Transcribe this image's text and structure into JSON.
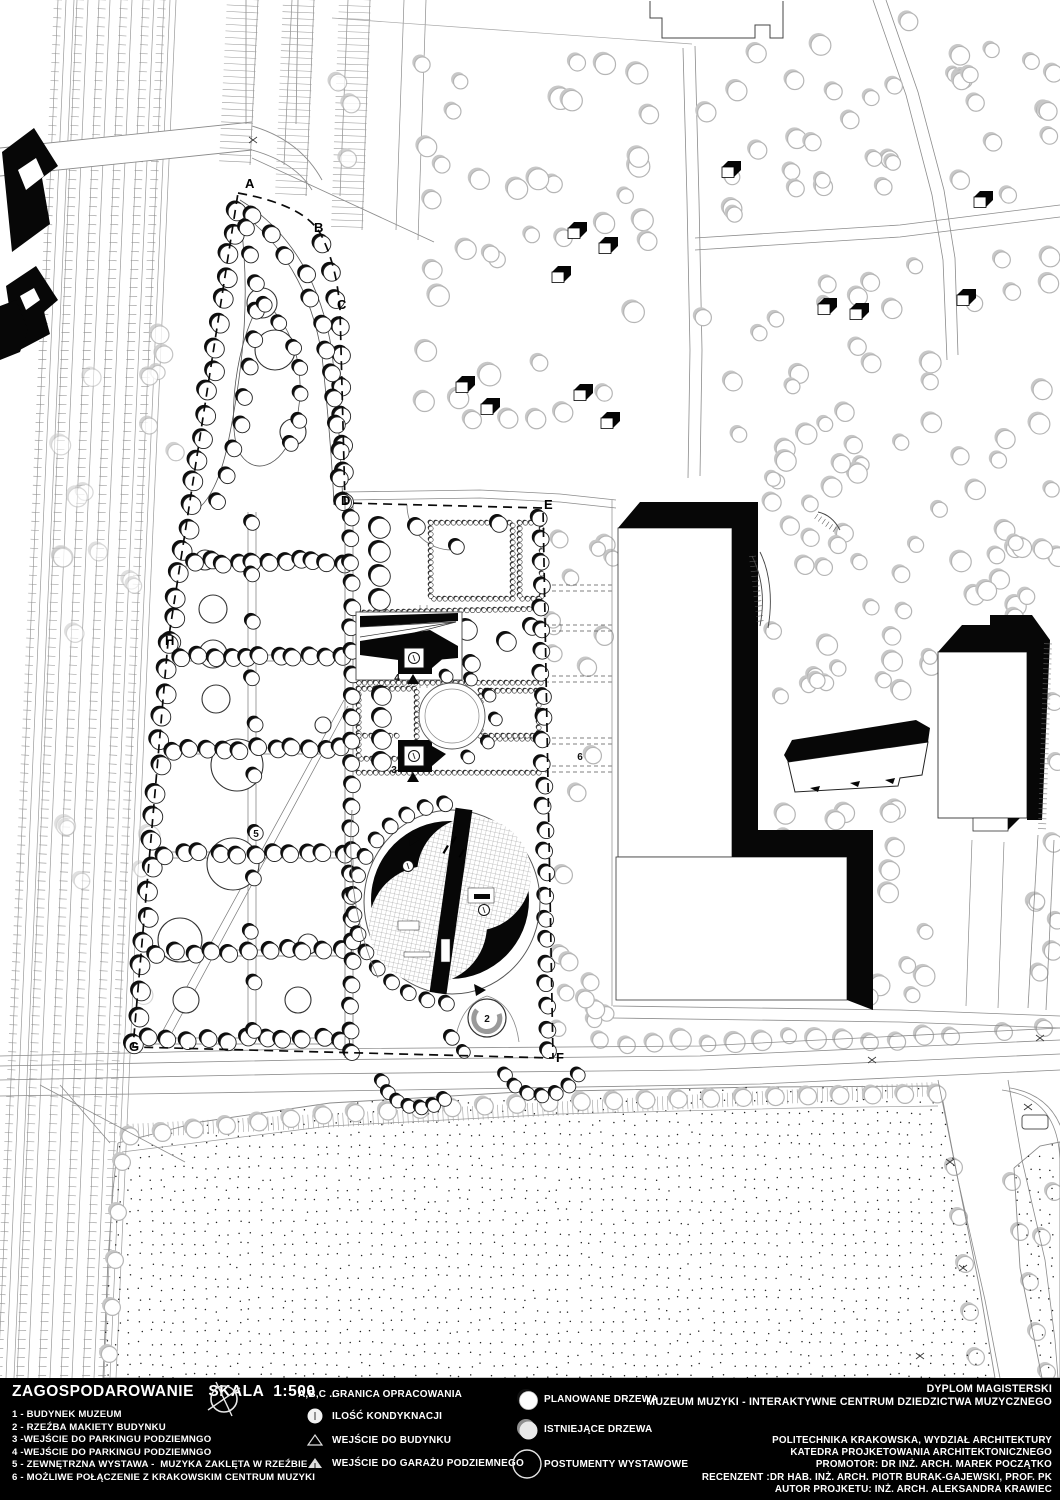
{
  "legend": {
    "title": "ZAGOSPODAROWANIE   SKALA  1:500",
    "numbered_items": [
      "1 - BUDYNEK MUZEUM",
      "2 - RZEŹBA MAKIETY BUDYNKU",
      "3 -WEJŚCIE DO PARKINGU PODZIEMNGO",
      "4 -WEJŚCIE DO PARKINGU PODZIEMNGO",
      "5 - ZEWNĘTRZNA WYSTAWA -  MUZYKA ZAKLĘTA W RZEŹBIE",
      "6 - MOŻLIWE POŁĄCZENIE Z KRAKOWSKIM CENTRUM MUZYKI"
    ],
    "symbols": [
      {
        "icon": "boundary-letters",
        "prefix": "A,B,C ..",
        "label": "GRANICA OPRACOWANIA"
      },
      {
        "icon": "storey-count-circle",
        "label": "ILOŚĆ KONDYKNACJI"
      },
      {
        "icon": "open-triangle",
        "label": "WEJŚCIE DO BUDYNKU"
      },
      {
        "icon": "filled-triangle",
        "label": "WEJŚCIE DO GARAŻU PODZIEMNEGO"
      }
    ],
    "tree_symbols": [
      {
        "icon": "planned-tree-circle",
        "label": "PLANOWANE DRZEWA"
      },
      {
        "icon": "existing-tree-circle",
        "label": "ISTNIEJĄCE DRZEWA"
      },
      {
        "icon": "pedestal-circle",
        "label": "POSTUMENTY WYSTAWOWE"
      }
    ]
  },
  "title_block": {
    "project_type": "DYPLOM MAGISTERSKI",
    "project_title": "MUZEUM MUZYKI - INTERAKTYWNE CENTRUM DZIEDZICTWA MUZYCZNEGO",
    "credits": [
      "POLITECHNIKA KRAKOWSKA, WYDZIAŁ ARCHITEKTURY",
      "KATEDRA PROJKETOWANIA ARCHITEKTONICZNEGO",
      "PROMOTOR: DR INŻ. ARCH. MAREK POCZĄTKO",
      "RECENZENT :DR HAB. INŻ. ARCH. PIOTR BURAK-GAJEWSKI, PROF. PK",
      "AUTOR PROJKETU: INŻ. ARCH. ALEKSANDRA KRAWIEC"
    ]
  },
  "map": {
    "boundary_letters": [
      {
        "t": "A",
        "x": 245,
        "y": 188
      },
      {
        "t": "B",
        "x": 314,
        "y": 232
      },
      {
        "t": "C",
        "x": 337,
        "y": 309
      },
      {
        "t": "D",
        "x": 341,
        "y": 505
      },
      {
        "t": "E",
        "x": 544,
        "y": 509
      },
      {
        "t": "F",
        "x": 556,
        "y": 1062
      },
      {
        "t": "G",
        "x": 129,
        "y": 1051
      },
      {
        "t": "H",
        "x": 165,
        "y": 645
      }
    ],
    "number_labels": [
      {
        "t": "4",
        "x": 397,
        "y": 681
      },
      {
        "t": "3",
        "x": 394,
        "y": 773
      },
      {
        "t": "5",
        "x": 256,
        "y": 837
      },
      {
        "t": "6",
        "x": 580,
        "y": 760
      },
      {
        "t": "2",
        "x": 487,
        "y": 1022
      }
    ],
    "storey_markers": [
      {
        "x": 408,
        "y": 866
      },
      {
        "x": 484,
        "y": 910
      },
      {
        "x": 414,
        "y": 658
      },
      {
        "x": 414,
        "y": 756
      }
    ],
    "colors": {
      "ink": "#000000",
      "paper": "#ffffff",
      "existing_tree": "#b9b9b9",
      "road_line": "#8c8c8c"
    }
  }
}
